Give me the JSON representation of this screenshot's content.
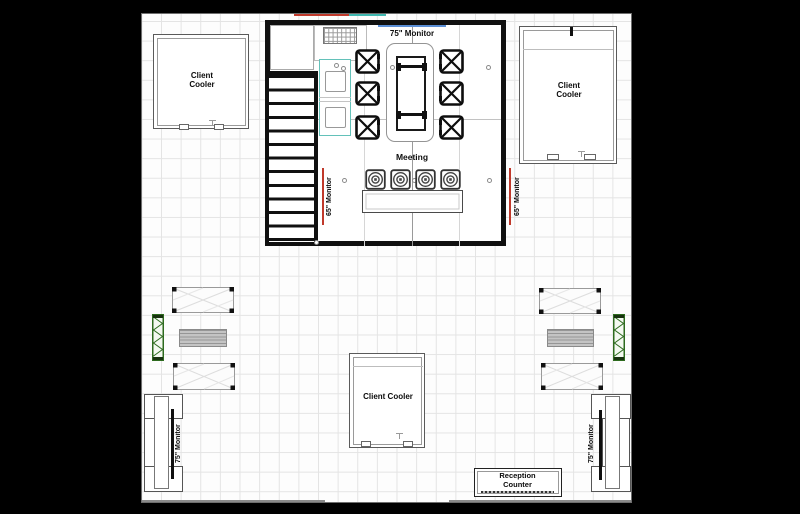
{
  "labels": {
    "monitor_75_top": "75\" Monitor",
    "meeting": "Meeting",
    "monitor_65_left": "65\" Monitor",
    "monitor_65_right": "65\" Monitor",
    "monitor_75_bottom_left": "75\" Monitor",
    "monitor_75_bottom_right": "75\" Monitor"
  },
  "rooms": {
    "cooler_top_left": {
      "line1": "Client",
      "line2": "Cooler"
    },
    "cooler_top_right": {
      "line1": "Client",
      "line2": "Cooler"
    },
    "cooler_bottom": {
      "label": "Client Cooler"
    },
    "reception": {
      "line1": "Reception",
      "line2": "Counter"
    }
  },
  "colors": {
    "wall": "#101010",
    "accent_red": "#c0392b",
    "accent_teal": "#3fb8b0",
    "monitor_blue": "#5b8fd6",
    "truss_green": "#2e6b1f",
    "bench_gray": "#c4c4c4"
  }
}
